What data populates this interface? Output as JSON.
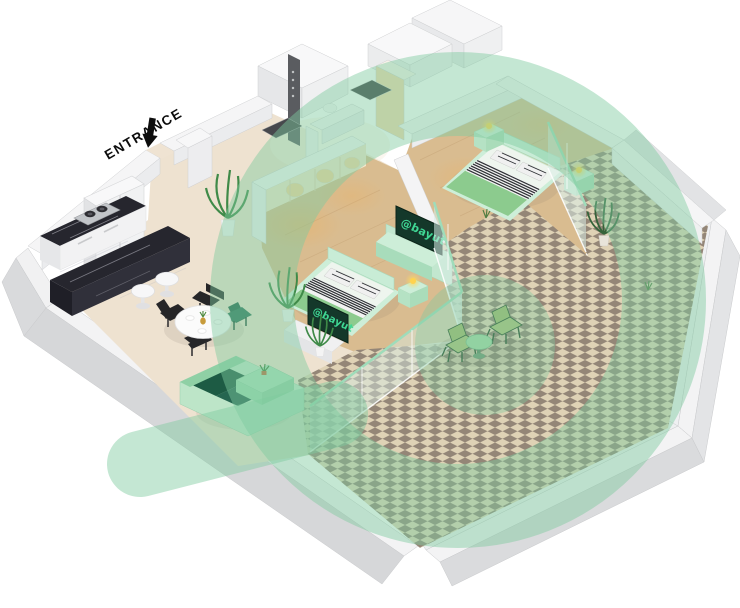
{
  "canvas": {
    "width": 740,
    "height": 608,
    "background": "#ffffff"
  },
  "entrance": {
    "label": "ENTRANCE"
  },
  "brand": {
    "watermark_text": "@bayut",
    "watermark_color": "#7ecba0",
    "tv_text_color": "#3fd794",
    "tv_screen_color": "#14382a"
  },
  "tvs": [
    {
      "text": "@bayut"
    },
    {
      "text": "@bayut"
    }
  ],
  "palette": {
    "wall_top": "#f5f5f6",
    "wall_face_light": "#ebecee",
    "wall_face_dark": "#d6d7d9",
    "floor_beige": "#eee2d0",
    "floor_wood": "#d9bc90",
    "tile_cream": "#e6dabc",
    "tile_taupe": "#97897b",
    "marble_dark": "#26262e",
    "furniture_mint": "#c8ecd6",
    "bed_green": "#8ccb8e",
    "sofa_green": "#1d5b44",
    "lamp_yellow": "#ffd34f"
  }
}
